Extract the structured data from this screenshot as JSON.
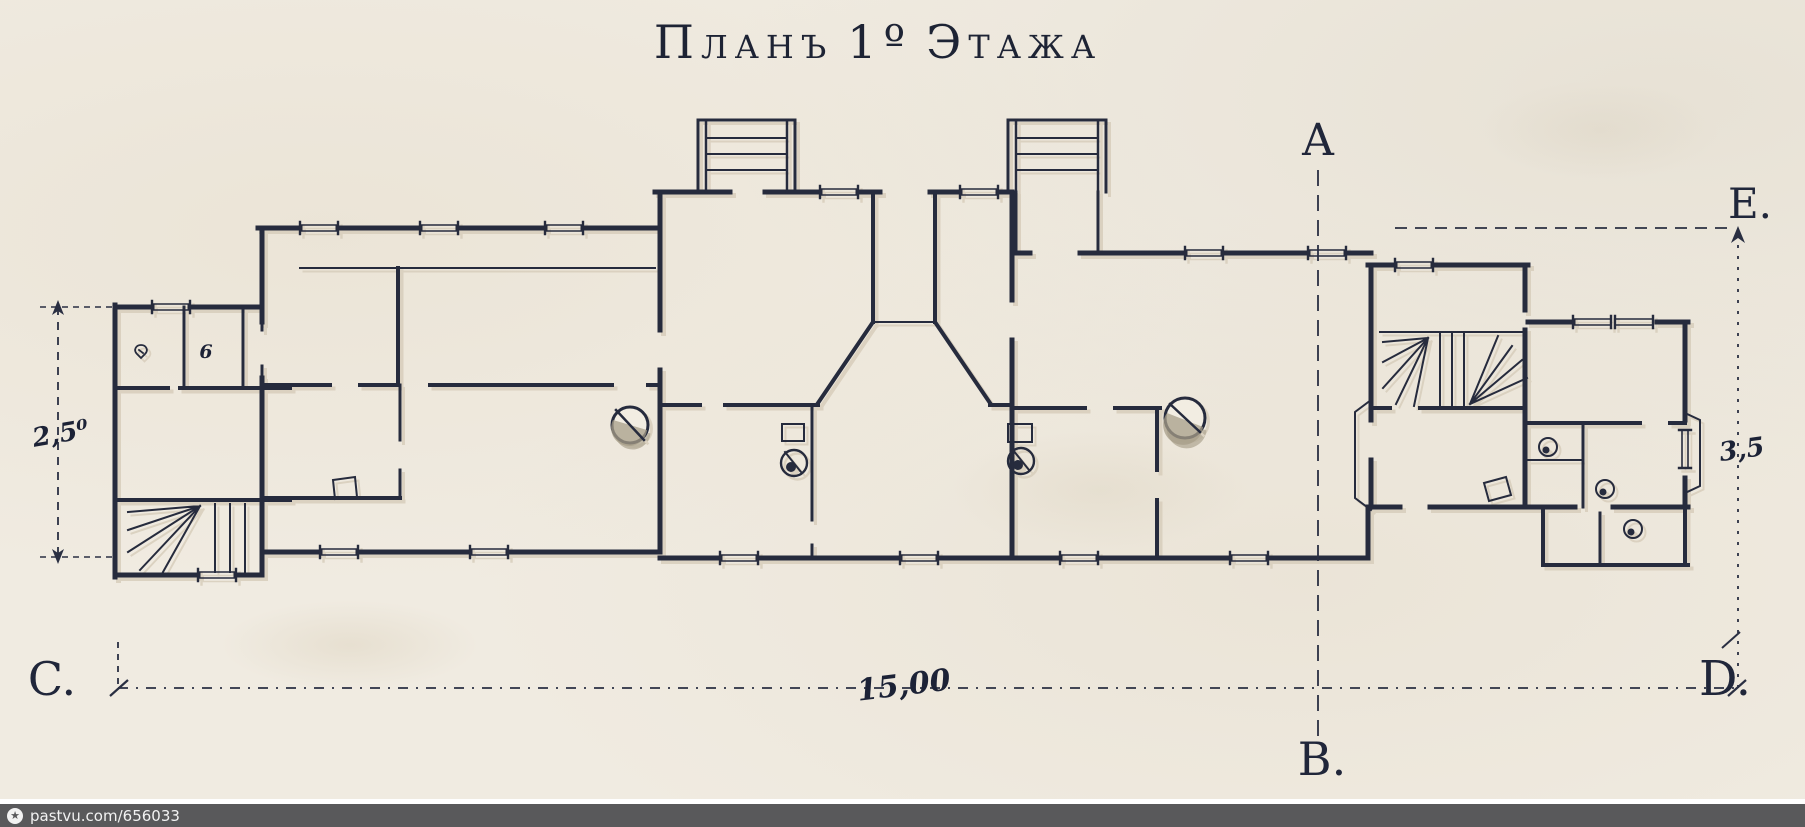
{
  "title": {
    "w1": "Планъ",
    "num": "1º",
    "w2": "Этажа"
  },
  "axis_markers": {
    "a": "A",
    "b": "B.",
    "c": "C.",
    "d": "D.",
    "e": "E."
  },
  "dimensions": {
    "left": "2,5⁰",
    "bottom": "15,00",
    "right": "3,5"
  },
  "plan": {
    "type": "architectural-floor-plan",
    "floor": "1",
    "features": "single-storey elongated house plan with two entrance porches, central entrance vestibule, two winder staircases, round stoves and small sanitary fixtures",
    "fixture_mark": "6"
  },
  "watermark": {
    "icon": "star-circle-icon",
    "text": "pastvu.com/656033"
  },
  "colors": {
    "paper": "#f0ebe1",
    "ink": "#262b3d",
    "wall_shadow": "#d8cebc",
    "stove_shade": "#a79d88",
    "watermark_bar": "#59595b",
    "watermark_text": "#f2f2f2"
  }
}
